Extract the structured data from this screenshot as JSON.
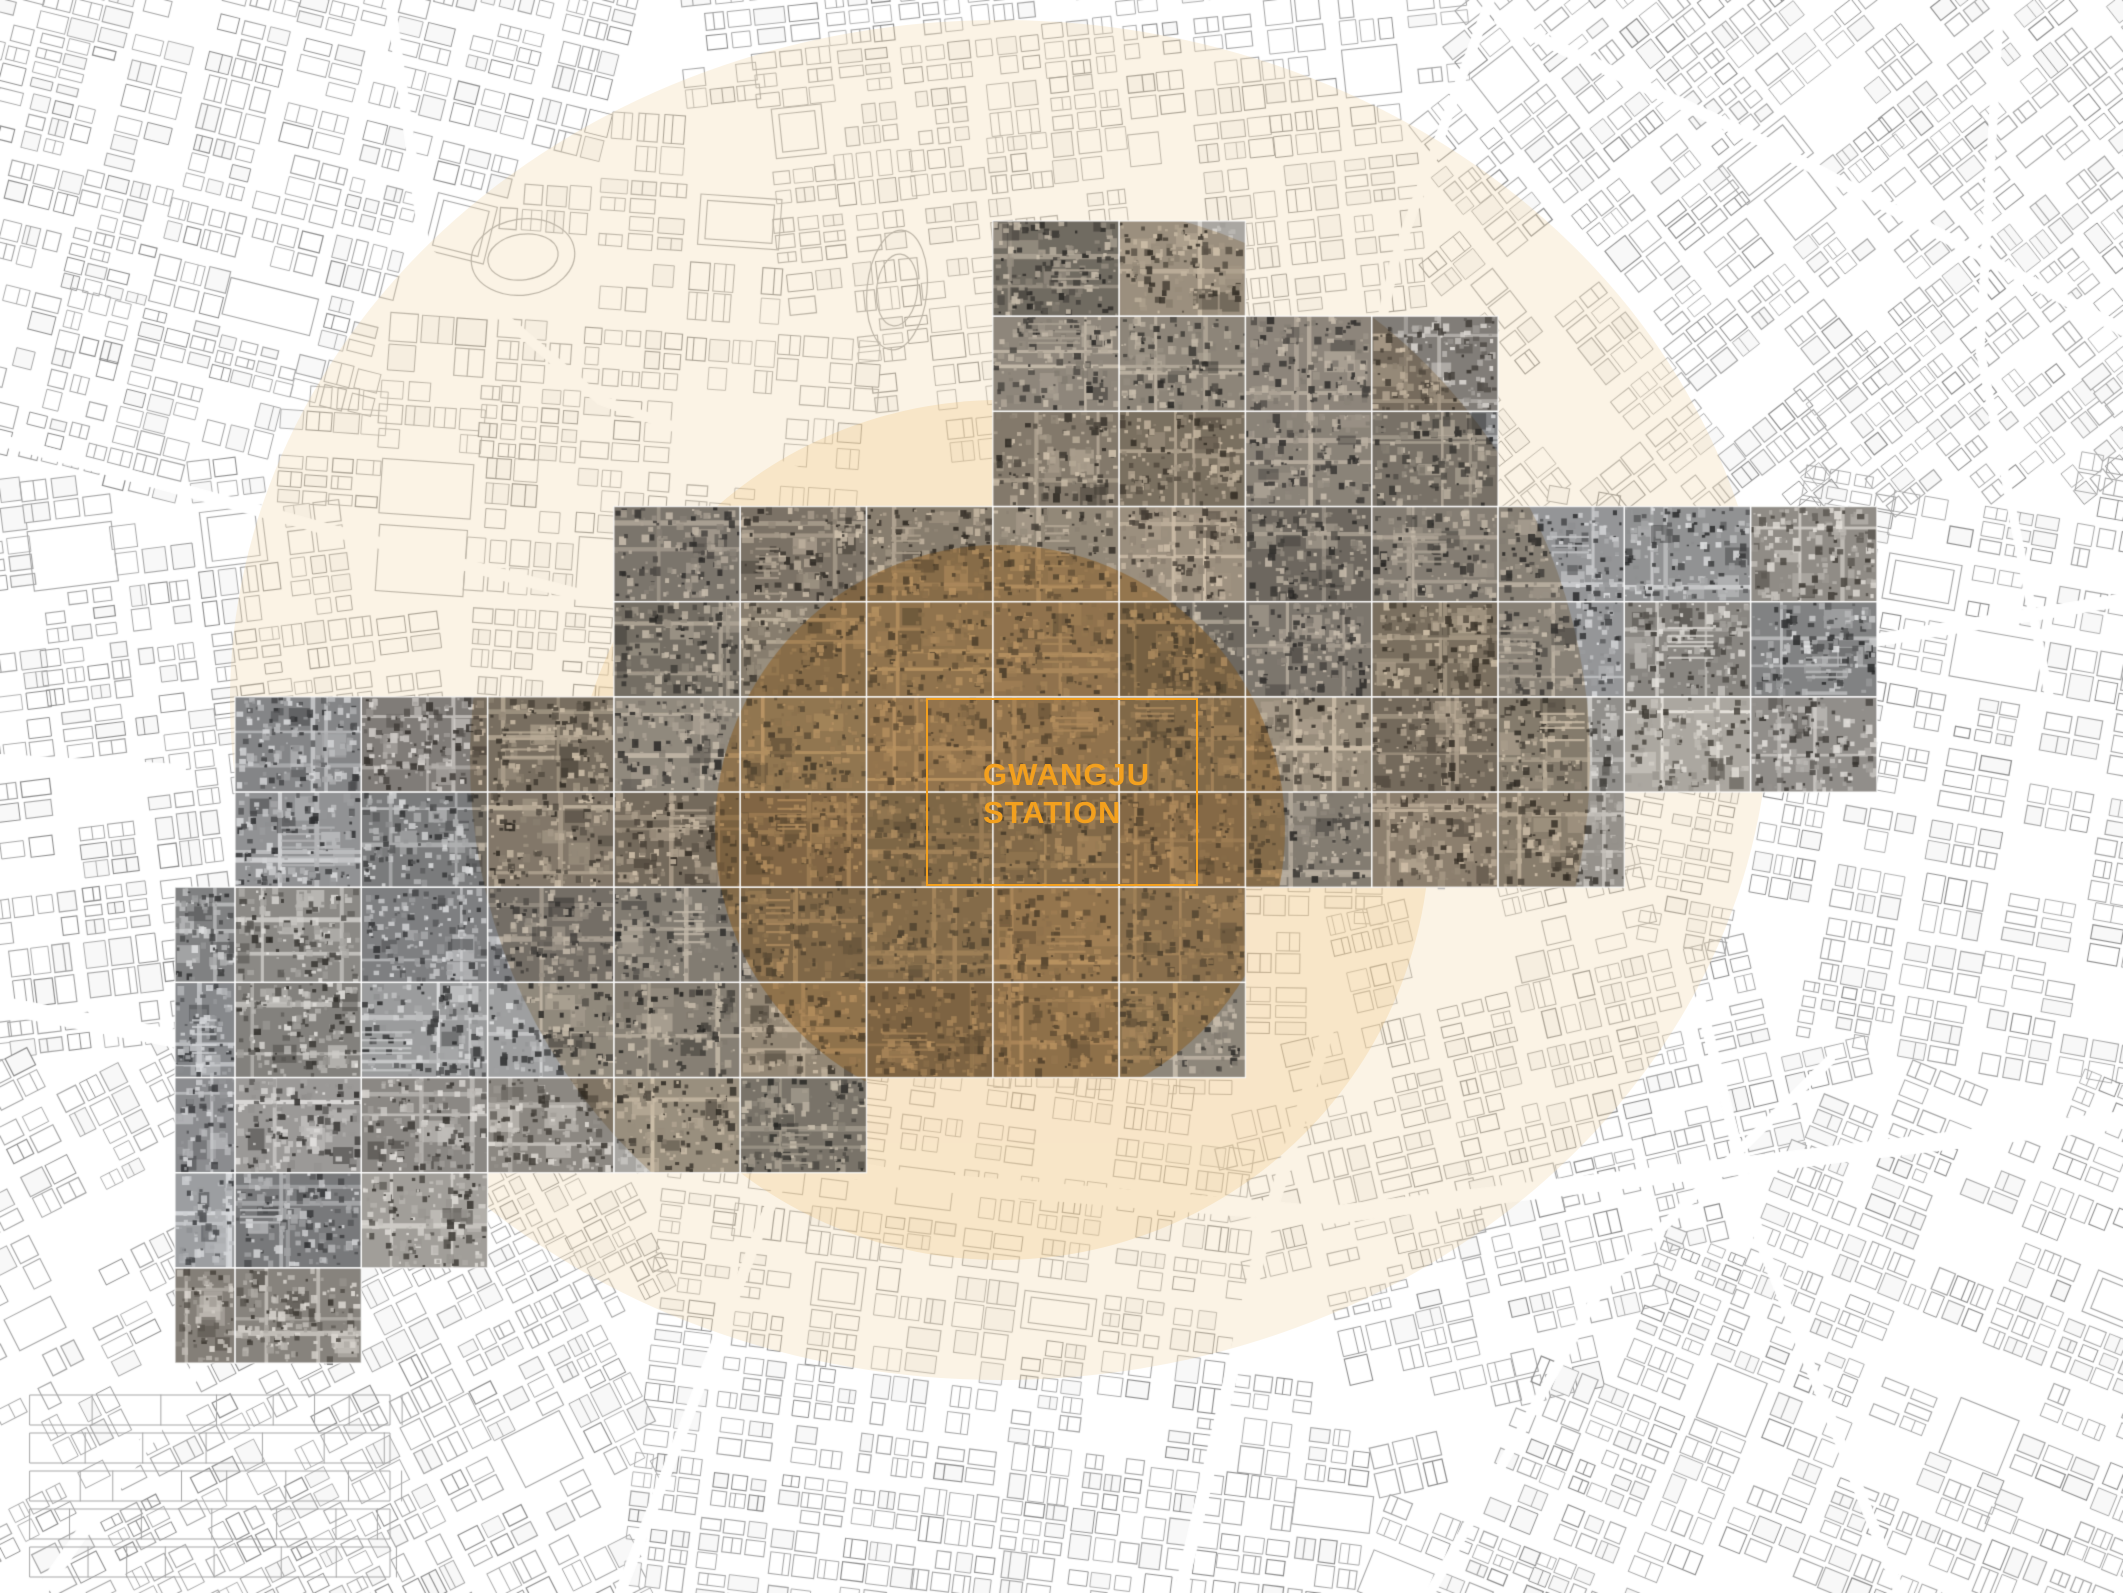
{
  "meta": {
    "figure_type": "urban-analysis-map",
    "description": "Figure-ground street map with aerial photo mosaic and radius overlays centered on Gwangju Station"
  },
  "canvas": {
    "width": 2123,
    "height": 1593,
    "background": "#ffffff"
  },
  "station": {
    "label": {
      "line1": "GWANGJU",
      "line2": "STATION"
    },
    "label_color": "#F3A01E",
    "label_font_px": 31,
    "label_line_height_px": 38,
    "rect": {
      "x": 926,
      "y": 698,
      "w": 273,
      "h": 189,
      "stroke": "#F3A01E",
      "stroke_width": 2.4
    },
    "label_offset": {
      "x": 57,
      "y": 58
    }
  },
  "overlays": {
    "outer_ellipse": {
      "cx": 1000,
      "cy": 700,
      "rx": 770,
      "ry": 680,
      "fill": "rgba(243,214,168,0.30)"
    },
    "inner_circle": {
      "cx": 1000,
      "cy": 830,
      "rx": 430,
      "ry": 430,
      "fill": "rgba(240,198,134,0.30)"
    },
    "tile_tint_mid": {
      "cx": 1030,
      "cy": 760,
      "rx": 560,
      "ry": 560,
      "fill": "rgb(233,219,198)"
    },
    "tile_tint_strong": {
      "cx": 1000,
      "cy": 830,
      "rx": 285,
      "ry": 285,
      "fill": "rgb(213,177,128)"
    },
    "tile_haze": {
      "cx": 1000,
      "cy": 830,
      "rx": 285,
      "ry": 285,
      "fill": "rgba(240,205,148,0.18)"
    }
  },
  "mosaic": {
    "origin_x": 235,
    "origin_y": 221,
    "tile_w": 126.3,
    "tile_h": 95.17,
    "seam_color": "rgba(255,255,255,0.75)",
    "seam_width": 1.4,
    "rows": [
      {
        "c0": 6,
        "c1": 7
      },
      {
        "c0": 6,
        "c1": 9
      },
      {
        "c0": 6,
        "c1": 9
      },
      {
        "c0": 3,
        "c1": 12
      },
      {
        "c0": 3,
        "c1": 12
      },
      {
        "c0": 0,
        "c1": 12
      },
      {
        "c0": 0,
        "c1": 10
      },
      {
        "c0": 0,
        "c1": 7,
        "ext": 60
      },
      {
        "c0": 0,
        "c1": 7,
        "ext": 60
      },
      {
        "c0": 0,
        "c1": 4,
        "ext": 60
      },
      {
        "c0": 0,
        "c1": 1,
        "ext": 60
      },
      {
        "c0": 0,
        "c1": 0,
        "ext": 60
      }
    ]
  },
  "map": {
    "seed": 11,
    "line_color": "#A6A6A6",
    "line_color_dark": "#8D8D8D",
    "building_fill": "#F8F8F8",
    "districts": [
      {
        "x": 260,
        "y": 170,
        "a": 14,
        "bw": 74,
        "bh": 52,
        "gap": 9
      },
      {
        "x": 1060,
        "y": 130,
        "a": -6,
        "bw": 64,
        "bh": 46,
        "gap": 8
      },
      {
        "x": 1800,
        "y": 230,
        "a": -38,
        "bw": 70,
        "bh": 48,
        "gap": 8
      },
      {
        "x": 560,
        "y": 470,
        "a": 4,
        "bw": 88,
        "bh": 62,
        "gap": 10
      },
      {
        "x": 260,
        "y": 760,
        "a": -7,
        "bw": 72,
        "bh": 50,
        "gap": 9
      },
      {
        "x": 1080,
        "y": 820,
        "a": 1,
        "bw": 70,
        "bh": 50,
        "gap": 9
      },
      {
        "x": 1850,
        "y": 760,
        "a": 10,
        "bw": 78,
        "bh": 54,
        "gap": 9
      },
      {
        "x": 330,
        "y": 1290,
        "a": -27,
        "bw": 70,
        "bh": 48,
        "gap": 9
      },
      {
        "x": 980,
        "y": 1330,
        "a": 7,
        "bw": 66,
        "bh": 46,
        "gap": 8
      },
      {
        "x": 1540,
        "y": 1120,
        "a": -13,
        "bw": 74,
        "bh": 50,
        "gap": 9
      },
      {
        "x": 1810,
        "y": 1420,
        "a": 22,
        "bw": 72,
        "bh": 50,
        "gap": 9
      }
    ],
    "roads": [
      {
        "pts": [
          [
            0,
            1005
          ],
          [
            520,
            1105
          ],
          [
            905,
            1180
          ],
          [
            1330,
            1215
          ],
          [
            2123,
            1120
          ]
        ],
        "w": 18
      },
      {
        "pts": [
          [
            1180,
            1593
          ],
          [
            1265,
            1230
          ],
          [
            1340,
            990
          ]
        ],
        "w": 13
      },
      {
        "pts": [
          [
            620,
            1593
          ],
          [
            760,
            1230
          ],
          [
            820,
            1090
          ]
        ],
        "w": 11
      },
      {
        "pts": [
          [
            40,
            1593
          ],
          [
            330,
            1180
          ],
          [
            520,
            1000
          ]
        ],
        "w": 13
      },
      {
        "pts": [
          [
            0,
            440
          ],
          [
            330,
            530
          ],
          [
            600,
            600
          ]
        ],
        "w": 12
      },
      {
        "pts": [
          [
            390,
            0
          ],
          [
            425,
            250
          ],
          [
            600,
            400
          ],
          [
            820,
            480
          ]
        ],
        "w": 10
      },
      {
        "pts": [
          [
            1490,
            0
          ],
          [
            1395,
            260
          ],
          [
            1360,
            420
          ]
        ],
        "w": 10
      },
      {
        "pts": [
          [
            2123,
            330
          ],
          [
            1760,
            140
          ],
          [
            1500,
            20
          ]
        ],
        "w": 12
      },
      {
        "pts": [
          [
            1877,
            640
          ],
          [
            2123,
            600
          ]
        ],
        "w": 13
      },
      {
        "pts": [
          [
            1900,
            1593
          ],
          [
            1760,
            1240
          ],
          [
            1700,
            1000
          ]
        ],
        "w": 11
      },
      {
        "pts": [
          [
            0,
            760
          ],
          [
            180,
            770
          ]
        ],
        "w": 12
      },
      {
        "pts": [
          [
            2000,
            0
          ],
          [
            1980,
            350
          ],
          [
            2050,
            700
          ]
        ],
        "w": 9
      },
      {
        "pts": [
          [
            1430,
            1593
          ],
          [
            1600,
            1290
          ],
          [
            1830,
            1060
          ]
        ],
        "w": 10
      }
    ],
    "ovals": [
      {
        "cx": 523,
        "cy": 257,
        "rx": 52,
        "ry": 38,
        "rot": -0.15
      },
      {
        "cx": 897,
        "cy": 290,
        "rx": 30,
        "ry": 60,
        "rot": 0.1
      }
    ],
    "field_strips": {
      "x": 30,
      "y": 1395,
      "w": 360,
      "h": 30,
      "count": 5,
      "gap": 8
    }
  }
}
